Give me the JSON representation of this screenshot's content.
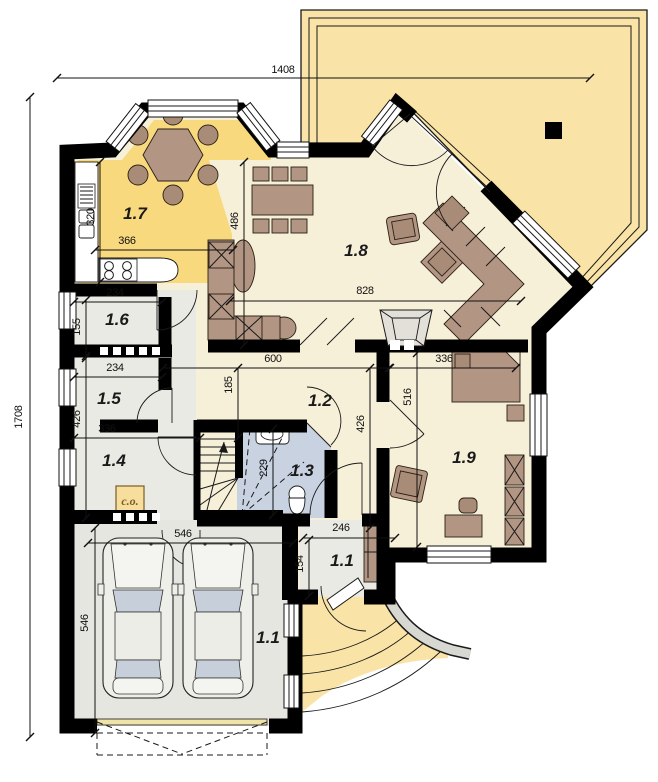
{
  "plan": {
    "colors": {
      "wall": "#000000",
      "terrace": "#FAE3A6",
      "kitchen_zone": "#F9D97E",
      "floor_main": "#F7F0D9",
      "floor_utility": "#EAEAE4",
      "floor_garage": "#E6E6E0",
      "floor_bath": "#C8D2E1",
      "furniture": "#B29582",
      "fireplace": "#E3E0DA",
      "path_gray": "#D8D8D2",
      "co_bg": "#F8DE9C",
      "car_body": "#EFEFEA",
      "car_glass": "#C7D0DA",
      "garage_door_line": "#EFE3A8",
      "ink": "#111111"
    },
    "room_labels": [
      {
        "text": "1.7",
        "x": 135,
        "y": 219
      },
      {
        "text": "1.8",
        "x": 356,
        "y": 256
      },
      {
        "text": "1.6",
        "x": 117,
        "y": 325
      },
      {
        "text": "1.5",
        "x": 109,
        "y": 404
      },
      {
        "text": "1.4",
        "x": 114,
        "y": 466
      },
      {
        "text": "1.2",
        "x": 320,
        "y": 406
      },
      {
        "text": "1.3",
        "x": 302,
        "y": 476
      },
      {
        "text": "1.9",
        "x": 464,
        "y": 463
      },
      {
        "text": "1.1",
        "x": 342,
        "y": 566
      },
      {
        "text": "1.1",
        "x": 268,
        "y": 643
      }
    ],
    "dimensions": [
      {
        "text": "1408",
        "x1": 57,
        "y1": 78,
        "x2": 590,
        "y2": 78,
        "tx": 283,
        "ty": 73,
        "vertical": false
      },
      {
        "text": "1708",
        "x1": 30,
        "y1": 97,
        "x2": 30,
        "y2": 737,
        "tx": 22,
        "ty": 417,
        "vertical": true
      },
      {
        "text": "320",
        "x1": 100,
        "y1": 162,
        "x2": 100,
        "y2": 282,
        "tx": 94,
        "ty": 217,
        "vertical": true
      },
      {
        "text": "366",
        "x1": 95,
        "y1": 250,
        "x2": 233,
        "y2": 250,
        "tx": 127,
        "ty": 244,
        "vertical": false
      },
      {
        "text": "486",
        "x1": 244,
        "y1": 162,
        "x2": 244,
        "y2": 345,
        "tx": 238,
        "ty": 221,
        "vertical": true
      },
      {
        "text": "234",
        "x1": 74,
        "y1": 302,
        "x2": 162,
        "y2": 302,
        "tx": 115,
        "ty": 296,
        "vertical": false
      },
      {
        "text": "155",
        "x1": 86,
        "y1": 300,
        "x2": 86,
        "y2": 356,
        "tx": 80,
        "ty": 327,
        "vertical": true
      },
      {
        "text": "234",
        "x1": 74,
        "y1": 377,
        "x2": 162,
        "y2": 377,
        "tx": 115,
        "ty": 371,
        "vertical": false
      },
      {
        "text": "426",
        "x1": 86,
        "y1": 358,
        "x2": 86,
        "y2": 518,
        "tx": 80,
        "ty": 419,
        "vertical": true
      },
      {
        "text": "336",
        "x1": 74,
        "y1": 438,
        "x2": 200,
        "y2": 438,
        "tx": 107,
        "ty": 432,
        "vertical": false
      },
      {
        "text": "600",
        "x1": 163,
        "y1": 368,
        "x2": 389,
        "y2": 368,
        "tx": 273,
        "ty": 362,
        "vertical": false
      },
      {
        "text": "185",
        "x1": 238,
        "y1": 368,
        "x2": 238,
        "y2": 438,
        "tx": 232,
        "ty": 385,
        "vertical": true
      },
      {
        "text": "426",
        "x1": 370,
        "y1": 368,
        "x2": 370,
        "y2": 528,
        "tx": 364,
        "ty": 424,
        "vertical": true
      },
      {
        "text": "516",
        "x1": 417,
        "y1": 353,
        "x2": 417,
        "y2": 547,
        "tx": 411,
        "ty": 397,
        "vertical": true
      },
      {
        "text": "336",
        "x1": 390,
        "y1": 368,
        "x2": 516,
        "y2": 368,
        "tx": 444,
        "ty": 362,
        "vertical": false
      },
      {
        "text": "828",
        "x1": 230,
        "y1": 301,
        "x2": 521,
        "y2": 301,
        "tx": 365,
        "ty": 294,
        "vertical": false
      },
      {
        "text": "229",
        "x1": 273,
        "y1": 429,
        "x2": 273,
        "y2": 515,
        "tx": 267,
        "ty": 468,
        "vertical": true
      },
      {
        "text": "246",
        "x1": 303,
        "y1": 538,
        "x2": 395,
        "y2": 538,
        "tx": 341,
        "ty": 531,
        "vertical": false
      },
      {
        "text": "154",
        "x1": 309,
        "y1": 540,
        "x2": 309,
        "y2": 596,
        "tx": 303,
        "ty": 564,
        "vertical": true
      },
      {
        "text": "546",
        "x1": 88,
        "y1": 543,
        "x2": 293,
        "y2": 543,
        "tx": 183,
        "ty": 537,
        "vertical": false
      },
      {
        "text": "546",
        "x1": 95,
        "y1": 528,
        "x2": 95,
        "y2": 733,
        "tx": 88,
        "ty": 623,
        "vertical": true
      }
    ],
    "annotations": {
      "co": "c.o."
    }
  }
}
